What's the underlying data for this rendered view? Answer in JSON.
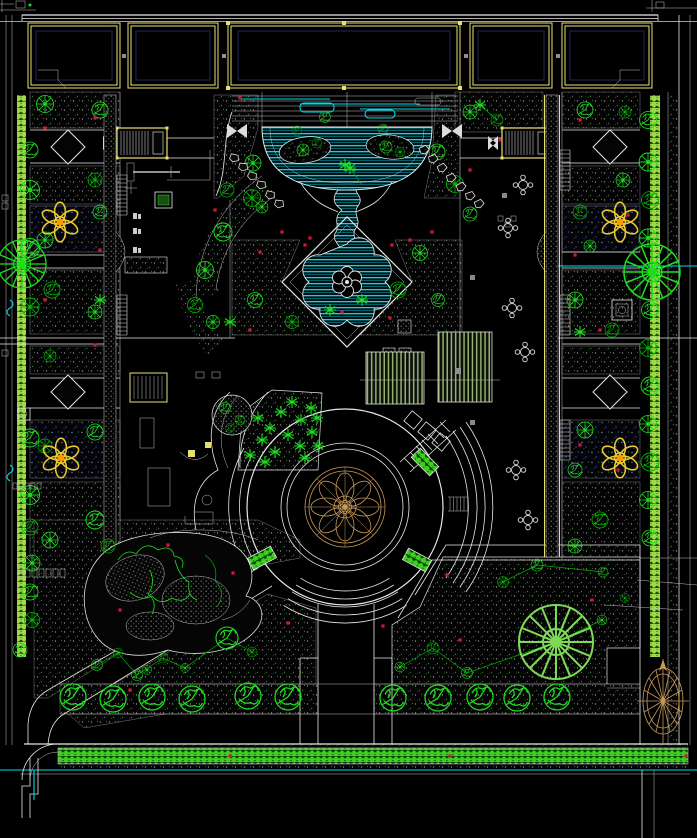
{
  "meta": {
    "title": "Residential Courtyard Landscape Site Plan (CAD drawing)",
    "drawing_type": "AutoCAD-style black-background landscape plan",
    "canvas_px": {
      "width": 697,
      "height": 838
    }
  },
  "palette": {
    "bg": "#000000",
    "line_white": "#e8e8e8",
    "line_dim": "#bdbdbd",
    "cad_yellow": "#e8df72",
    "water_cyan": "#00dbe8",
    "water_deep": "#0b7c8c",
    "tree_green": "#1fdd1f",
    "tree_green_dark": "#00b400",
    "tree_green_light": "#7ed957",
    "hedge_green": "#3ecf1e",
    "band_green": "#9fd84a",
    "tan": "#c89858",
    "flower_gold": "#e6c832",
    "flower_orange": "#ff9900",
    "marker_red": "#d41836",
    "hatch_gray": "#8a8a8a",
    "hatch_green": "#2f7a2f",
    "navy": "#24307a",
    "pergola_green": "#96b072",
    "rock_gray": "#999999"
  },
  "legend": {
    "building_outline": {
      "color": "#e8df72",
      "count": 5
    },
    "entrance_stoops": {
      "color": "#e8df72",
      "count": 2
    },
    "water_cascade_pond": {
      "color": "#00dbe8",
      "parts": [
        "terrace",
        "semicircular pond",
        "winding stream",
        "diamond pond with fountain"
      ]
    },
    "central_plaza": {
      "parts": [
        "mandala paving medallion",
        "concentric rings",
        "terraced step arcs",
        "planter boxes"
      ],
      "medallion_color": "#c89858"
    },
    "pergolas": {
      "color": "#96b072",
      "count": 2
    },
    "flower_medallions": {
      "color": "#e6c832",
      "count": 4
    },
    "rockery_mound": {
      "color": "#999999"
    },
    "compass_rose": {
      "color": "#c89858"
    },
    "bottom_hedge_band": {
      "color": "#3ecf1e"
    },
    "planting_hatch": {
      "style": "dotted gray/green on black"
    }
  },
  "plants": {
    "trees": [
      {
        "x": 325,
        "y": 117,
        "s": 0.55,
        "t": "s",
        "c": "g1"
      },
      {
        "x": 297,
        "y": 131,
        "s": 0.5,
        "t": "s",
        "c": "g2"
      },
      {
        "x": 383,
        "y": 129,
        "s": 0.5,
        "t": "s",
        "c": "g1"
      },
      {
        "x": 303,
        "y": 150,
        "s": 0.6,
        "t": "r",
        "c": "g1"
      },
      {
        "x": 317,
        "y": 143,
        "s": 0.5,
        "t": "s",
        "c": "g2"
      },
      {
        "x": 386,
        "y": 147,
        "s": 0.6,
        "t": "s",
        "c": "g1"
      },
      {
        "x": 400,
        "y": 152,
        "s": 0.5,
        "t": "r",
        "c": "g2"
      },
      {
        "x": 253,
        "y": 163,
        "s": 0.8,
        "t": "r",
        "c": "g1"
      },
      {
        "x": 227,
        "y": 190,
        "s": 0.7,
        "t": "s",
        "c": "g2"
      },
      {
        "x": 262,
        "y": 207,
        "s": 0.6,
        "t": "r",
        "c": "g1"
      },
      {
        "x": 470,
        "y": 112,
        "s": 0.7,
        "t": "r",
        "c": "g1"
      },
      {
        "x": 497,
        "y": 120,
        "s": 0.6,
        "t": "s",
        "c": "g2"
      },
      {
        "x": 437,
        "y": 152,
        "s": 0.8,
        "t": "s",
        "c": "g1"
      },
      {
        "x": 455,
        "y": 184,
        "s": 0.85,
        "t": "r",
        "c": "g2"
      },
      {
        "x": 470,
        "y": 214,
        "s": 0.7,
        "t": "s",
        "c": "g1"
      },
      {
        "x": 205,
        "y": 270,
        "s": 0.85,
        "t": "r",
        "c": "g1"
      },
      {
        "x": 223,
        "y": 232,
        "s": 0.9,
        "t": "s",
        "c": "g1"
      },
      {
        "x": 252,
        "y": 198,
        "s": 0.85,
        "t": "r",
        "c": "g2"
      },
      {
        "x": 195,
        "y": 305,
        "s": 0.75,
        "t": "s",
        "c": "g2"
      },
      {
        "x": 213,
        "y": 322,
        "s": 0.65,
        "t": "r",
        "c": "g1"
      },
      {
        "x": 255,
        "y": 300,
        "s": 0.75,
        "t": "s",
        "c": "g1"
      },
      {
        "x": 292,
        "y": 322,
        "s": 0.65,
        "t": "r",
        "c": "g2"
      },
      {
        "x": 420,
        "y": 253,
        "s": 0.75,
        "t": "r",
        "c": "g1"
      },
      {
        "x": 398,
        "y": 290,
        "s": 0.8,
        "t": "s",
        "c": "g2"
      },
      {
        "x": 438,
        "y": 300,
        "s": 0.65,
        "t": "s",
        "c": "g1"
      },
      {
        "x": 100,
        "y": 110,
        "s": 0.8,
        "t": "s",
        "c": "g1"
      },
      {
        "x": 45,
        "y": 104,
        "s": 0.85,
        "t": "r",
        "c": "g1"
      },
      {
        "x": 95,
        "y": 180,
        "s": 0.7,
        "t": "r",
        "c": "g2"
      },
      {
        "x": 100,
        "y": 212,
        "s": 0.7,
        "t": "s",
        "c": "g1"
      },
      {
        "x": 45,
        "y": 240,
        "s": 0.8,
        "t": "r",
        "c": "g1"
      },
      {
        "x": 52,
        "y": 290,
        "s": 0.8,
        "t": "s",
        "c": "g2"
      },
      {
        "x": 95,
        "y": 312,
        "s": 0.7,
        "t": "r",
        "c": "g1"
      },
      {
        "x": 50,
        "y": 356,
        "s": 0.6,
        "t": "r",
        "c": "g2"
      },
      {
        "x": 95,
        "y": 432,
        "s": 0.8,
        "t": "s",
        "c": "g1"
      },
      {
        "x": 45,
        "y": 446,
        "s": 0.7,
        "t": "r",
        "c": "g2"
      },
      {
        "x": 95,
        "y": 520,
        "s": 0.9,
        "t": "s",
        "c": "g1"
      },
      {
        "x": 50,
        "y": 540,
        "s": 0.8,
        "t": "r",
        "c": "g1"
      },
      {
        "x": 108,
        "y": 546,
        "s": 0.7,
        "t": "s",
        "c": "g2"
      },
      {
        "x": 30,
        "y": 150,
        "s": 0.8,
        "t": "s",
        "c": "g1"
      },
      {
        "x": 30,
        "y": 190,
        "s": 0.95,
        "t": "r",
        "c": "g1"
      },
      {
        "x": 30,
        "y": 248,
        "s": 0.95,
        "t": "s",
        "c": "g1"
      },
      {
        "x": 30,
        "y": 307,
        "s": 0.9,
        "t": "r",
        "c": "g2"
      },
      {
        "x": 30,
        "y": 438,
        "s": 0.9,
        "t": "s",
        "c": "g1"
      },
      {
        "x": 30,
        "y": 495,
        "s": 0.95,
        "t": "r",
        "c": "g1"
      },
      {
        "x": 30,
        "y": 527,
        "s": 0.8,
        "t": "s",
        "c": "g2"
      },
      {
        "x": 32,
        "y": 563,
        "s": 0.8,
        "t": "r",
        "c": "g1"
      },
      {
        "x": 30,
        "y": 592,
        "s": 0.8,
        "t": "s",
        "c": "g1"
      },
      {
        "x": 32,
        "y": 620,
        "s": 0.75,
        "t": "r",
        "c": "g2"
      },
      {
        "x": 20,
        "y": 650,
        "s": 0.7,
        "t": "s",
        "c": "g1"
      },
      {
        "x": 22,
        "y": 264,
        "s": 2.4,
        "t": "b",
        "c": "g1"
      },
      {
        "x": 585,
        "y": 110,
        "s": 0.8,
        "t": "s",
        "c": "g1"
      },
      {
        "x": 625,
        "y": 112,
        "s": 0.6,
        "t": "r",
        "c": "g2"
      },
      {
        "x": 623,
        "y": 180,
        "s": 0.7,
        "t": "r",
        "c": "g1"
      },
      {
        "x": 580,
        "y": 212,
        "s": 0.7,
        "t": "s",
        "c": "g2"
      },
      {
        "x": 590,
        "y": 246,
        "s": 0.6,
        "t": "r",
        "c": "g1"
      },
      {
        "x": 575,
        "y": 300,
        "s": 0.8,
        "t": "r",
        "c": "g1"
      },
      {
        "x": 612,
        "y": 330,
        "s": 0.7,
        "t": "s",
        "c": "g2"
      },
      {
        "x": 585,
        "y": 430,
        "s": 0.8,
        "t": "r",
        "c": "g1"
      },
      {
        "x": 575,
        "y": 470,
        "s": 0.7,
        "t": "s",
        "c": "g1"
      },
      {
        "x": 600,
        "y": 520,
        "s": 0.8,
        "t": "s",
        "c": "g2"
      },
      {
        "x": 575,
        "y": 546,
        "s": 0.7,
        "t": "r",
        "c": "g1"
      },
      {
        "x": 648,
        "y": 120,
        "s": 0.85,
        "t": "s",
        "c": "g1"
      },
      {
        "x": 648,
        "y": 162,
        "s": 0.9,
        "t": "r",
        "c": "g1"
      },
      {
        "x": 650,
        "y": 200,
        "s": 0.85,
        "t": "s",
        "c": "g2"
      },
      {
        "x": 648,
        "y": 238,
        "s": 0.9,
        "t": "r",
        "c": "g1"
      },
      {
        "x": 650,
        "y": 310,
        "s": 0.85,
        "t": "s",
        "c": "g1"
      },
      {
        "x": 648,
        "y": 348,
        "s": 0.85,
        "t": "r",
        "c": "g2"
      },
      {
        "x": 650,
        "y": 386,
        "s": 0.9,
        "t": "s",
        "c": "g1"
      },
      {
        "x": 648,
        "y": 424,
        "s": 0.85,
        "t": "r",
        "c": "g1"
      },
      {
        "x": 650,
        "y": 462,
        "s": 0.9,
        "t": "s",
        "c": "g2"
      },
      {
        "x": 648,
        "y": 500,
        "s": 0.85,
        "t": "r",
        "c": "g1"
      },
      {
        "x": 650,
        "y": 538,
        "s": 0.8,
        "t": "s",
        "c": "g1"
      },
      {
        "x": 652,
        "y": 272,
        "s": 2.8,
        "t": "b",
        "c": "g1"
      },
      {
        "x": 97,
        "y": 665,
        "s": 0.55,
        "t": "s",
        "c": "g1"
      },
      {
        "x": 118,
        "y": 653,
        "s": 0.5,
        "t": "r",
        "c": "g2"
      },
      {
        "x": 137,
        "y": 675,
        "s": 0.55,
        "t": "s",
        "c": "g1"
      },
      {
        "x": 147,
        "y": 670,
        "s": 0.45,
        "t": "r",
        "c": "g1"
      },
      {
        "x": 163,
        "y": 658,
        "s": 0.5,
        "t": "s",
        "c": "g2"
      },
      {
        "x": 185,
        "y": 668,
        "s": 0.45,
        "t": "r",
        "c": "g1"
      },
      {
        "x": 227,
        "y": 638,
        "s": 1.1,
        "t": "s",
        "c": "g1"
      },
      {
        "x": 252,
        "y": 652,
        "s": 0.5,
        "t": "r",
        "c": "g2"
      },
      {
        "x": 537,
        "y": 565,
        "s": 0.6,
        "t": "s",
        "c": "g1"
      },
      {
        "x": 503,
        "y": 582,
        "s": 0.55,
        "t": "r",
        "c": "g2"
      },
      {
        "x": 603,
        "y": 572,
        "s": 0.5,
        "t": "s",
        "c": "g1"
      },
      {
        "x": 602,
        "y": 620,
        "s": 0.5,
        "t": "r",
        "c": "g1"
      },
      {
        "x": 433,
        "y": 648,
        "s": 0.6,
        "t": "s",
        "c": "g2"
      },
      {
        "x": 400,
        "y": 667,
        "s": 0.5,
        "t": "r",
        "c": "g1"
      },
      {
        "x": 467,
        "y": 673,
        "s": 0.55,
        "t": "s",
        "c": "g1"
      },
      {
        "x": 625,
        "y": 598,
        "s": 0.45,
        "t": "r",
        "c": "g2"
      },
      {
        "x": 556,
        "y": 642,
        "s": 3.7,
        "t": "b",
        "c": "g3"
      },
      {
        "x": 73,
        "y": 697,
        "s": 1.3,
        "t": "s",
        "c": "g1"
      },
      {
        "x": 113,
        "y": 699,
        "s": 1.3,
        "t": "s",
        "c": "g1"
      },
      {
        "x": 152,
        "y": 697,
        "s": 1.3,
        "t": "s",
        "c": "g1"
      },
      {
        "x": 192,
        "y": 699,
        "s": 1.3,
        "t": "s",
        "c": "g1"
      },
      {
        "x": 248,
        "y": 696,
        "s": 1.3,
        "t": "s",
        "c": "g1"
      },
      {
        "x": 288,
        "y": 697,
        "s": 1.3,
        "t": "s",
        "c": "g1"
      },
      {
        "x": 393,
        "y": 698,
        "s": 1.3,
        "t": "s",
        "c": "g1"
      },
      {
        "x": 438,
        "y": 698,
        "s": 1.3,
        "t": "s",
        "c": "g1"
      },
      {
        "x": 480,
        "y": 697,
        "s": 1.3,
        "t": "s",
        "c": "g1"
      },
      {
        "x": 517,
        "y": 698,
        "s": 1.3,
        "t": "s",
        "c": "g1"
      },
      {
        "x": 557,
        "y": 697,
        "s": 1.3,
        "t": "s",
        "c": "g1"
      },
      {
        "x": 225,
        "y": 408,
        "s": 0.55,
        "t": "s",
        "c": "g1"
      },
      {
        "x": 240,
        "y": 420,
        "s": 0.5,
        "t": "s",
        "c": "g1"
      },
      {
        "x": 230,
        "y": 428,
        "s": 0.45,
        "t": "s",
        "c": "g2"
      }
    ],
    "shrub_stars": [
      [
        250,
        455
      ],
      [
        262,
        440
      ],
      [
        258,
        418
      ],
      [
        270,
        428
      ],
      [
        281,
        412
      ],
      [
        292,
        402
      ],
      [
        301,
        420
      ],
      [
        311,
        408
      ],
      [
        288,
        435
      ],
      [
        300,
        446
      ],
      [
        312,
        432
      ],
      [
        318,
        446
      ],
      [
        275,
        452
      ],
      [
        265,
        462
      ],
      [
        305,
        458
      ],
      [
        317,
        418
      ],
      [
        350,
        168
      ],
      [
        362,
        300
      ],
      [
        330,
        310
      ],
      [
        230,
        322
      ],
      [
        100,
        300
      ],
      [
        580,
        332
      ],
      [
        480,
        105
      ],
      [
        345,
        165
      ]
    ]
  },
  "markers": {
    "red_dots": [
      [
        240,
        98
      ],
      [
        282,
        232
      ],
      [
        310,
        238
      ],
      [
        260,
        252
      ],
      [
        410,
        240
      ],
      [
        432,
        232
      ],
      [
        390,
        318
      ],
      [
        250,
        330
      ],
      [
        215,
        210
      ],
      [
        470,
        170
      ],
      [
        500,
        140
      ],
      [
        95,
        118
      ],
      [
        45,
        128
      ],
      [
        100,
        250
      ],
      [
        45,
        300
      ],
      [
        95,
        345
      ],
      [
        580,
        120
      ],
      [
        628,
        215
      ],
      [
        575,
        255
      ],
      [
        600,
        330
      ],
      [
        580,
        445
      ],
      [
        618,
        470
      ],
      [
        233,
        573
      ],
      [
        288,
        623
      ],
      [
        383,
        626
      ],
      [
        447,
        575
      ],
      [
        130,
        690
      ],
      [
        460,
        640
      ],
      [
        592,
        600
      ],
      [
        686,
        756
      ],
      [
        450,
        756
      ],
      [
        230,
        756
      ],
      [
        305,
        245
      ],
      [
        392,
        245
      ],
      [
        342,
        312
      ],
      [
        168,
        545
      ],
      [
        120,
        610
      ]
    ],
    "stepping_stones": [
      [
        234,
        158,
        20
      ],
      [
        243,
        167,
        15
      ],
      [
        252,
        176,
        25
      ],
      [
        261,
        185,
        18
      ],
      [
        270,
        195,
        22
      ],
      [
        279,
        204,
        15
      ],
      [
        424,
        150,
        -18
      ],
      [
        433,
        159,
        -12
      ],
      [
        442,
        168,
        -20
      ],
      [
        451,
        178,
        -15
      ],
      [
        461,
        187,
        -22
      ],
      [
        470,
        196,
        -12
      ],
      [
        479,
        204,
        -18
      ]
    ],
    "tables": [
      [
        523,
        185
      ],
      [
        508,
        228
      ],
      [
        512,
        308
      ],
      [
        525,
        352
      ],
      [
        516,
        470
      ],
      [
        528,
        520
      ]
    ],
    "diamonds": [
      [
        68,
        147
      ],
      [
        610,
        147
      ],
      [
        68,
        392
      ],
      [
        610,
        392
      ]
    ],
    "flower_medallions": [
      [
        60,
        222
      ],
      [
        620,
        222
      ],
      [
        61,
        458
      ],
      [
        620,
        458
      ]
    ],
    "planter_boxes": [
      [
        262,
        558,
        -28
      ],
      [
        417,
        560,
        28
      ],
      [
        425,
        462,
        45
      ]
    ]
  }
}
